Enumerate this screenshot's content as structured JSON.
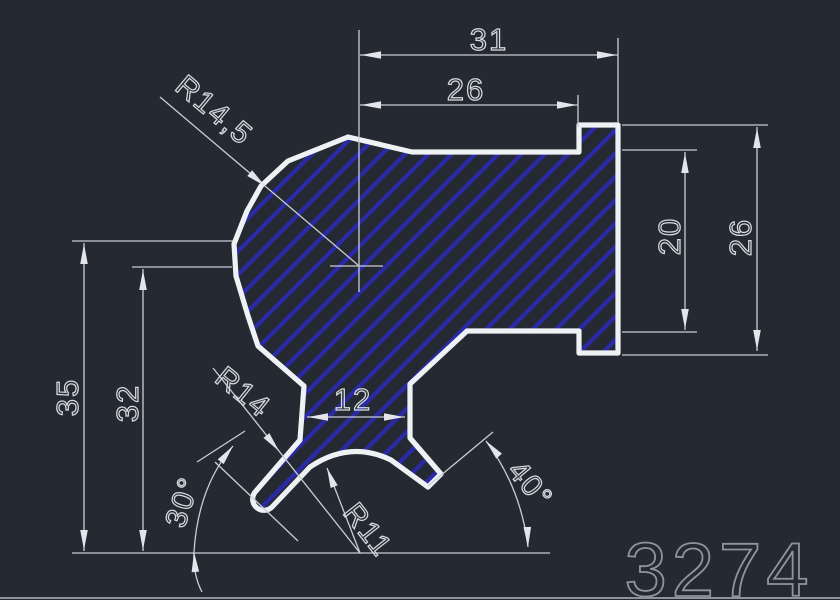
{
  "drawing_number": "3274",
  "dimensions": {
    "overall_width": "31",
    "body_width": "26",
    "inner_height": "20",
    "flange_height": "26",
    "overall_height": "35",
    "center_height": "32",
    "neck_width": "12",
    "main_radius": "R14,5",
    "fillet_radius": "R14",
    "bottom_radius": "R11",
    "left_angle": "30°",
    "right_angle": "40°"
  },
  "colors": {
    "background": "#252931",
    "part_outline": "#eff2f5",
    "hatch_blue": "#2a2aa6",
    "dimension_lines": "#c9ced4",
    "dimension_text": "#d7dbdf",
    "drawing_number_text": "#8f959d"
  }
}
